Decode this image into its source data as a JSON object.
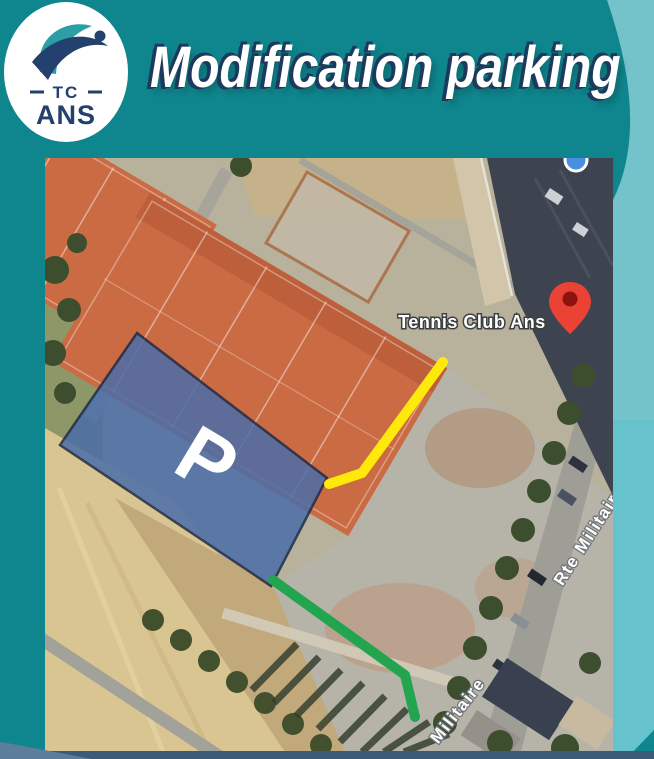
{
  "theme": {
    "background_teal": "#0f868e",
    "corner_teal_light": "#74c2ca",
    "bottom_bar_slate": "#3a5a77",
    "bottom_wedge_slate": "#5d7d9d",
    "title_color": "#ffffff",
    "title_shadow": "#1d3a5c",
    "logo_navy": "#24406e",
    "logo_teal": "#2e9ea6"
  },
  "header": {
    "title": "Modification parking",
    "logo": {
      "tc": "TC",
      "ans": "ANS"
    }
  },
  "map": {
    "labels": {
      "place": "Tennis Club Ans",
      "street_main": "Rte Militaire",
      "street_bottom": "Militaire",
      "parking": "P"
    },
    "colors": {
      "parking_fill": "#4a6da8",
      "parking_border": "#1b2a4a",
      "route_yellow": "#ffe90a",
      "route_green": "#23a550",
      "pin_red": "#ea4335",
      "pin_inner": "#8f130d",
      "location_dot": "#4a90e2",
      "court_clay": "#ca6b44",
      "building_roof": "#3d4450"
    }
  }
}
